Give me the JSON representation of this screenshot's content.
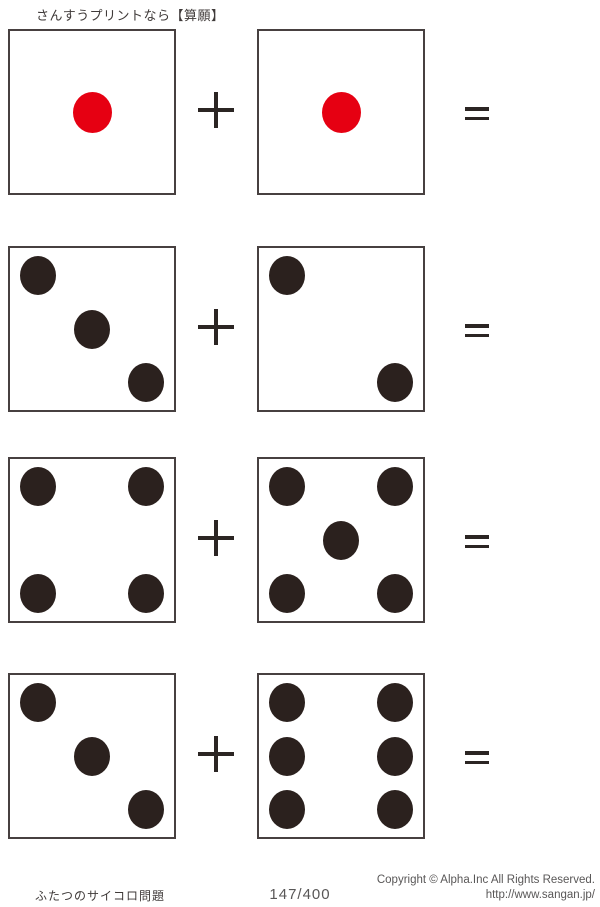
{
  "page": {
    "title": "さんすうプリントなら【算願】"
  },
  "colors": {
    "red_pip": "#e60012",
    "black_pip": "#2b211e",
    "die_border": "#474040",
    "operator": "#2b2523",
    "text_dark": "#3f3a39",
    "text_gray": "#595757"
  },
  "operators": {
    "plus": "+",
    "equals": "="
  },
  "problems": [
    {
      "row": 1,
      "left_pips": 1,
      "right_pips": 1,
      "pip_color": "red"
    },
    {
      "row": 2,
      "left_pips": 3,
      "right_pips": 2,
      "pip_color": "black"
    },
    {
      "row": 3,
      "left_pips": 4,
      "right_pips": 5,
      "pip_color": "black"
    },
    {
      "row": 4,
      "left_pips": 3,
      "right_pips": 6,
      "pip_color": "black"
    }
  ],
  "footer": {
    "worksheet_title": "ふたつのサイコロ問題",
    "page_number": "147/400",
    "copyright": "Copyright ©  Alpha.Inc All Rights Reserved.",
    "url": "http://www.sangan.jp/"
  }
}
